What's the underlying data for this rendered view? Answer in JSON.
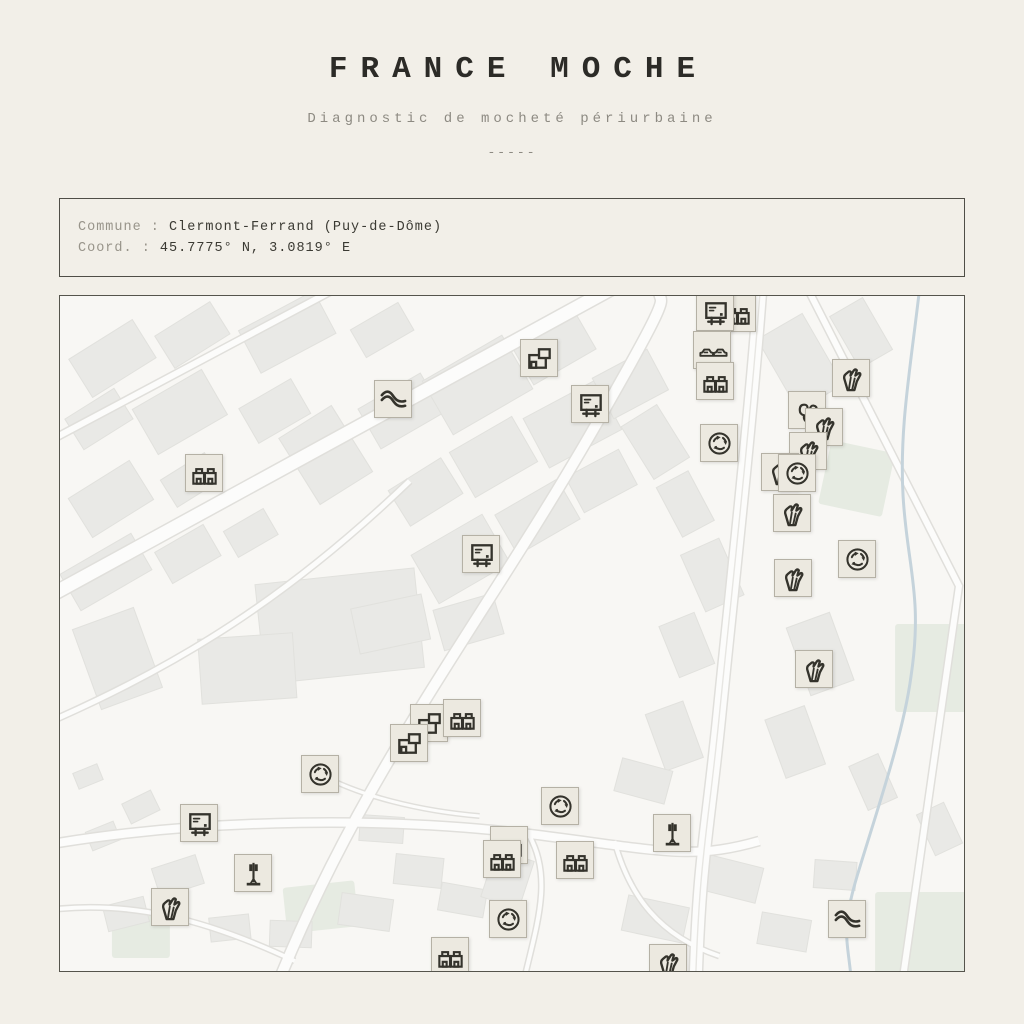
{
  "header": {
    "title": "FRANCE MOCHE",
    "subtitle": "Diagnostic de mocheté périurbaine",
    "divider": "-----"
  },
  "info": {
    "commune_label": "Commune :",
    "commune_value": "Clermont-Ferrand (Puy-de-Dôme)",
    "coord_label": "Coord. :",
    "coord_value": "45.7775° N, 3.0819° E"
  },
  "map": {
    "colors": {
      "page_bg": "#f2efe8",
      "map_bg": "#f8f7f4",
      "building": "#e9e9e6",
      "road": "#fcfcfb",
      "road_casing": "#e0dfdb",
      "river": "#c5d3db",
      "green": "#e6ebe2",
      "marker_bg": "#ece9e0",
      "marker_border": "#b5b1a5",
      "icon_stroke": "#34332c"
    },
    "markers": [
      {
        "type": "wave",
        "x": 333,
        "y": 103
      },
      {
        "type": "bigbox",
        "x": 479,
        "y": 62
      },
      {
        "type": "billboard",
        "x": 530,
        "y": 108
      },
      {
        "type": "twin",
        "x": 144,
        "y": 177
      },
      {
        "type": "billboard",
        "x": 421,
        "y": 258
      },
      {
        "type": "twin",
        "x": 677,
        "y": 17
      },
      {
        "type": "billboard",
        "x": 655,
        "y": 16
      },
      {
        "type": "cars",
        "x": 652,
        "y": 54
      },
      {
        "type": "twin",
        "x": 655,
        "y": 85
      },
      {
        "type": "roundabout",
        "x": 659,
        "y": 147
      },
      {
        "type": "hand",
        "x": 791,
        "y": 82
      },
      {
        "type": "trees",
        "x": 747,
        "y": 114
      },
      {
        "type": "hand",
        "x": 764,
        "y": 131
      },
      {
        "type": "hand",
        "x": 748,
        "y": 155
      },
      {
        "type": "hand",
        "x": 720,
        "y": 176
      },
      {
        "type": "roundabout",
        "x": 737,
        "y": 177
      },
      {
        "type": "hand",
        "x": 732,
        "y": 217
      },
      {
        "type": "roundabout",
        "x": 797,
        "y": 263
      },
      {
        "type": "hand",
        "x": 733,
        "y": 282
      },
      {
        "type": "hand",
        "x": 754,
        "y": 373
      },
      {
        "type": "bigbox",
        "x": 369,
        "y": 427
      },
      {
        "type": "bigbox",
        "x": 349,
        "y": 447
      },
      {
        "type": "twin",
        "x": 402,
        "y": 422
      },
      {
        "type": "roundabout",
        "x": 260,
        "y": 478
      },
      {
        "type": "billboard",
        "x": 139,
        "y": 527
      },
      {
        "type": "antenna",
        "x": 193,
        "y": 577
      },
      {
        "type": "hand",
        "x": 110,
        "y": 611
      },
      {
        "type": "roundabout",
        "x": 500,
        "y": 510
      },
      {
        "type": "antenna",
        "x": 612,
        "y": 537
      },
      {
        "type": "twin",
        "x": 449,
        "y": 549
      },
      {
        "type": "twin",
        "x": 442,
        "y": 563
      },
      {
        "type": "twin",
        "x": 515,
        "y": 564
      },
      {
        "type": "roundabout",
        "x": 448,
        "y": 623
      },
      {
        "type": "twin",
        "x": 390,
        "y": 660
      },
      {
        "type": "hand",
        "x": 608,
        "y": 667
      },
      {
        "type": "wave",
        "x": 787,
        "y": 623
      }
    ]
  }
}
